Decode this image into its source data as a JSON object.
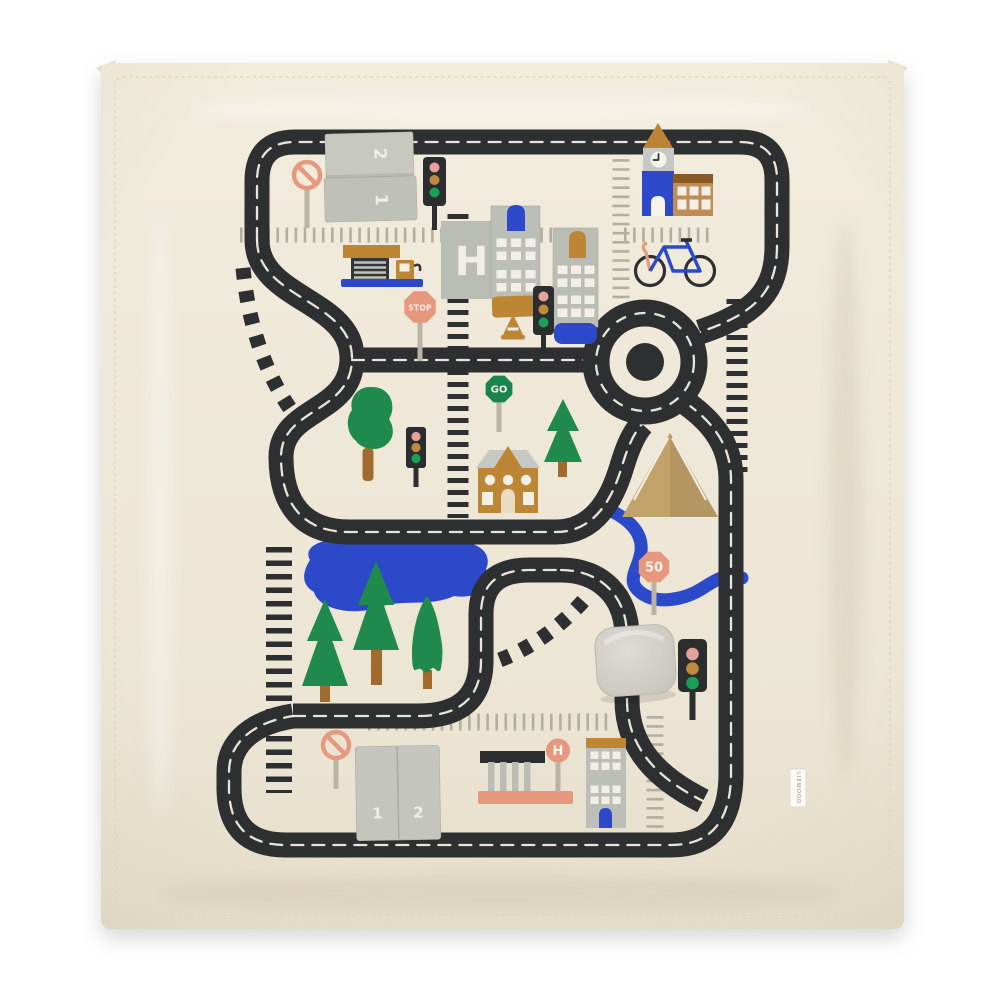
{
  "image": {
    "kind_label": "play-blanket product photo",
    "background_color": "#ffffff"
  },
  "blanket": {
    "base_color": "#efe8d8",
    "road_color": "#2e2f31",
    "accent_colors": {
      "blue": "#2b49c8",
      "green": "#1f8a4c",
      "ochre": "#bd8634",
      "salmon": "#e5987e",
      "grey": "#bcbfb7",
      "tan": "#c2a26b"
    },
    "top_pocket": {
      "panel_numbers": [
        "2",
        "1"
      ]
    },
    "bottom_pocket": {
      "panel_numbers": [
        "1",
        "2"
      ]
    },
    "signs": {
      "stop": "STOP",
      "go": "GO",
      "speed_limit": "50",
      "helipad_letter": "H",
      "bus_stop_letter": "H"
    },
    "tag": {
      "label": "LIEWOOD"
    }
  }
}
